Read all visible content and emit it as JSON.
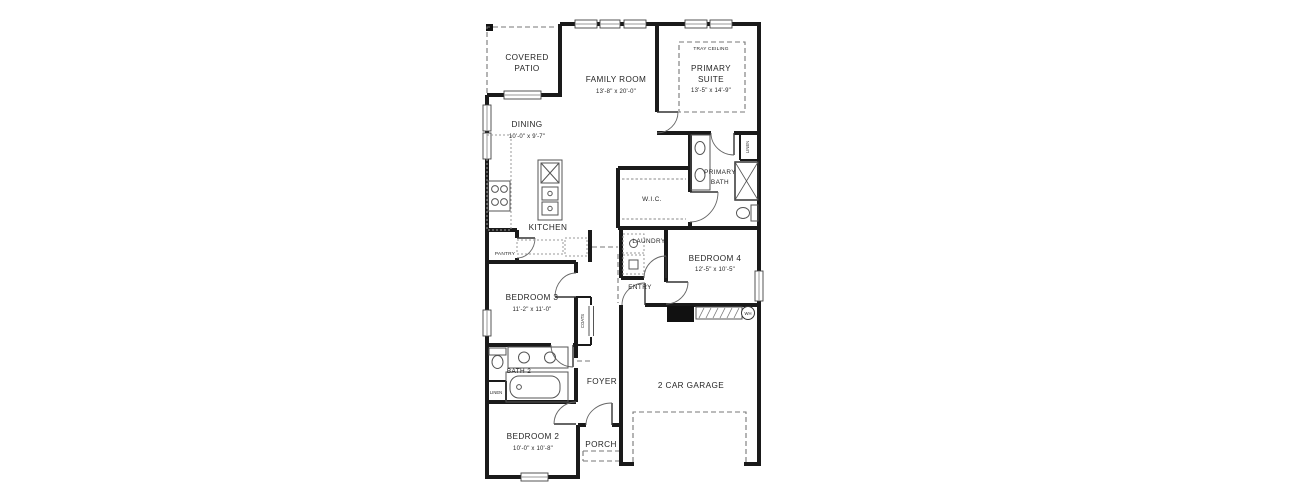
{
  "plan": {
    "rooms": {
      "covered_patio": {
        "name_line1": "COVERED",
        "name_line2": "PATIO"
      },
      "family_room": {
        "name": "FAMILY ROOM",
        "dims": "13'-8\" x 20'-0\""
      },
      "primary_suite": {
        "ceiling": "TRAY CEILING",
        "name_line1": "PRIMARY",
        "name_line2": "SUITE",
        "dims": "13'-5\" x 14'-9\""
      },
      "dining": {
        "name": "DINING",
        "dims": "10'-0\" x 9'-7\""
      },
      "kitchen": {
        "name": "KITCHEN"
      },
      "pantry": {
        "name": "PANTRY"
      },
      "wic": {
        "name": "W.I.C."
      },
      "primary_bath": {
        "name_line1": "PRIMARY",
        "name_line2": "BATH"
      },
      "linen_primary": {
        "name": "LINEN"
      },
      "laundry": {
        "name": "LAUNDRY"
      },
      "bedroom4": {
        "name": "BEDROOM 4",
        "dims": "12'-5\" x 10'-5\""
      },
      "entry": {
        "name": "ENTRY"
      },
      "coats": {
        "name": "COATS"
      },
      "bedroom3": {
        "name": "BEDROOM 3",
        "dims": "11'-2\" x 11'-0\""
      },
      "bath2": {
        "name": "BATH 2"
      },
      "linen2": {
        "name": "LINEN"
      },
      "bedroom2": {
        "name": "BEDROOM 2",
        "dims": "10'-0\" x 10'-8\""
      },
      "foyer": {
        "name": "FOYER"
      },
      "porch": {
        "name": "PORCH"
      },
      "garage": {
        "name": "2 CAR GARAGE"
      }
    },
    "fixtures": {
      "water_heater": "WH"
    },
    "colors": {
      "wall": "#1a1a1a",
      "background": "#ffffff",
      "line": "#555555",
      "text": "#262626"
    }
  }
}
